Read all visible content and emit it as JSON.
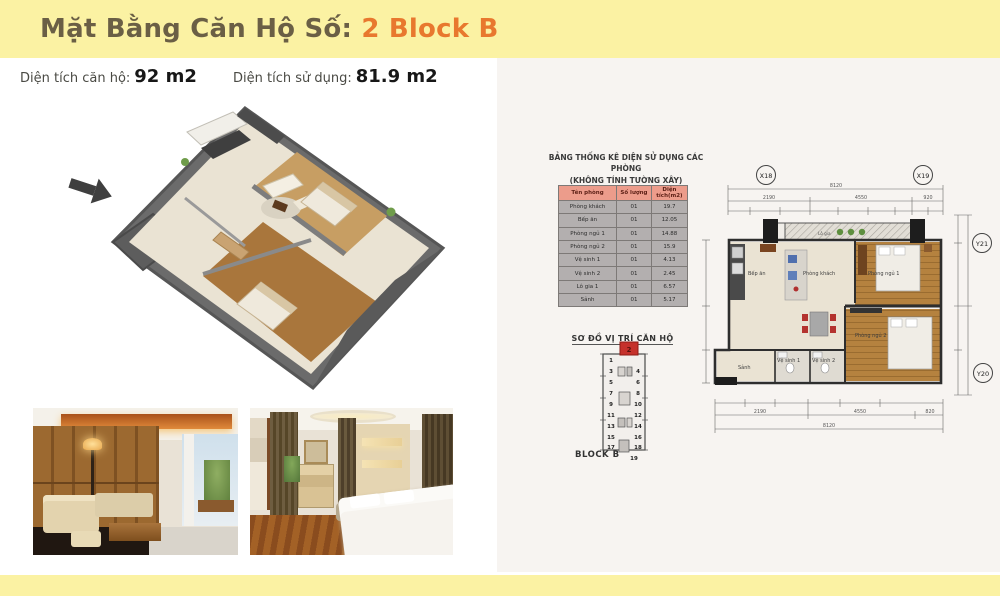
{
  "header": {
    "title_prefix": "Mặt Bằng Căn Hộ Số:",
    "title_highlight": "2 Block B"
  },
  "stats": {
    "area_label": "Diện tích căn hộ:",
    "area_value": "92 m2",
    "usable_label": "Diện tích sử dụng:",
    "usable_value": "81.9 m2"
  },
  "room_table": {
    "title_line1": "BẢNG THỐNG KÊ DIỆN SỬ DỤNG CÁC PHÒNG",
    "title_line2": "(KHÔNG TÍNH TƯỜNG XÂY)",
    "headers": [
      "Tên phòng",
      "Số lượng",
      "Diện tích(m2)"
    ],
    "rows": [
      [
        "Phòng khách",
        "01",
        "19.7"
      ],
      [
        "Bếp ăn",
        "01",
        "12.05"
      ],
      [
        "Phòng ngủ 1",
        "01",
        "14.88"
      ],
      [
        "Phòng ngủ 2",
        "01",
        "15.9"
      ],
      [
        "Vệ sinh 1",
        "01",
        "4.13"
      ],
      [
        "Vệ sinh 2",
        "01",
        "2.45"
      ],
      [
        "Lô gia 1",
        "01",
        "6.57"
      ],
      [
        "Sảnh",
        "01",
        "5.17"
      ]
    ]
  },
  "location": {
    "title": "SƠ ĐỒ VỊ TRÍ CĂN HỘ",
    "block_label": "BLOCK B",
    "highlighted_unit": "2",
    "units_left": [
      "1",
      "3",
      "5",
      "7",
      "9",
      "11",
      "13",
      "15",
      "17"
    ],
    "units_right": [
      "4",
      "6",
      "8",
      "10",
      "12",
      "14",
      "16",
      "18",
      "19"
    ]
  },
  "tech_plan": {
    "grid": {
      "x1": "X18",
      "x2": "X19",
      "y1": "Y21",
      "y2": "Y20"
    },
    "rooms": {
      "kitchen": "Bếp ăn",
      "living": "Phòng khách",
      "bed1": "Phòng ngủ 1",
      "bed2": "Phòng ngủ 2",
      "wc1": "Vệ sinh 1",
      "wc2": "Vệ sinh 2",
      "hall": "Sảnh",
      "balcony": "Lô gia"
    },
    "dims": {
      "top_total": "8120",
      "top": [
        "2190",
        "4550",
        "920"
      ],
      "bottom_total": "8120",
      "bottom": [
        "2190",
        "4550",
        "820"
      ]
    }
  },
  "colors": {
    "band_yellow": "#FBF2A3",
    "title_brown": "#6A5F45",
    "accent_orange": "#E8782E",
    "panel_bg": "#F7F4F1",
    "table_header_bg": "#EC9C8B",
    "table_cell_bg": "#B3AFAF",
    "unit_red": "#C5312B",
    "wood": "#B5823F",
    "floor_beige": "#EAE3D3"
  }
}
